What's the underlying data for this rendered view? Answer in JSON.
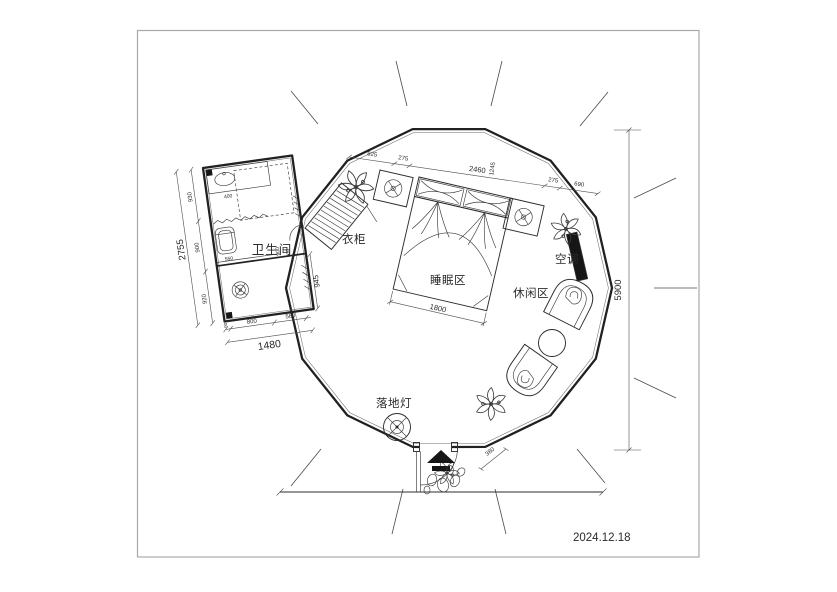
{
  "drawing": {
    "date": "2024.12.18",
    "labels": {
      "bathroom": "卫生间",
      "wardrobe": "衣柜",
      "sleeping_area": "睡眠区",
      "leisure_area": "休闲区",
      "air_conditioner": "空调",
      "floor_lamp": "落地灯"
    },
    "dims": {
      "overall_height": "5900",
      "top_chain": [
        "825",
        "275",
        "2460",
        "275",
        "690"
      ],
      "top_chain_side": "1245",
      "bed_width": "1800",
      "entrance_width": "380",
      "bath_left_segments": [
        "930",
        "900",
        "920"
      ],
      "bath_left_total": "2755",
      "bath_bottom_offset": "90",
      "bath_bottom_segments": [
        "800",
        "580"
      ],
      "bath_bottom_total": "1480",
      "bath_right": "945",
      "bath_inner_toilet": "550",
      "bath_inner_vanity": "400",
      "bath_inner_a": "900",
      "bath_inner_b": "930"
    },
    "colors": {
      "fill_dark": "#161616",
      "line": "#212121"
    }
  }
}
